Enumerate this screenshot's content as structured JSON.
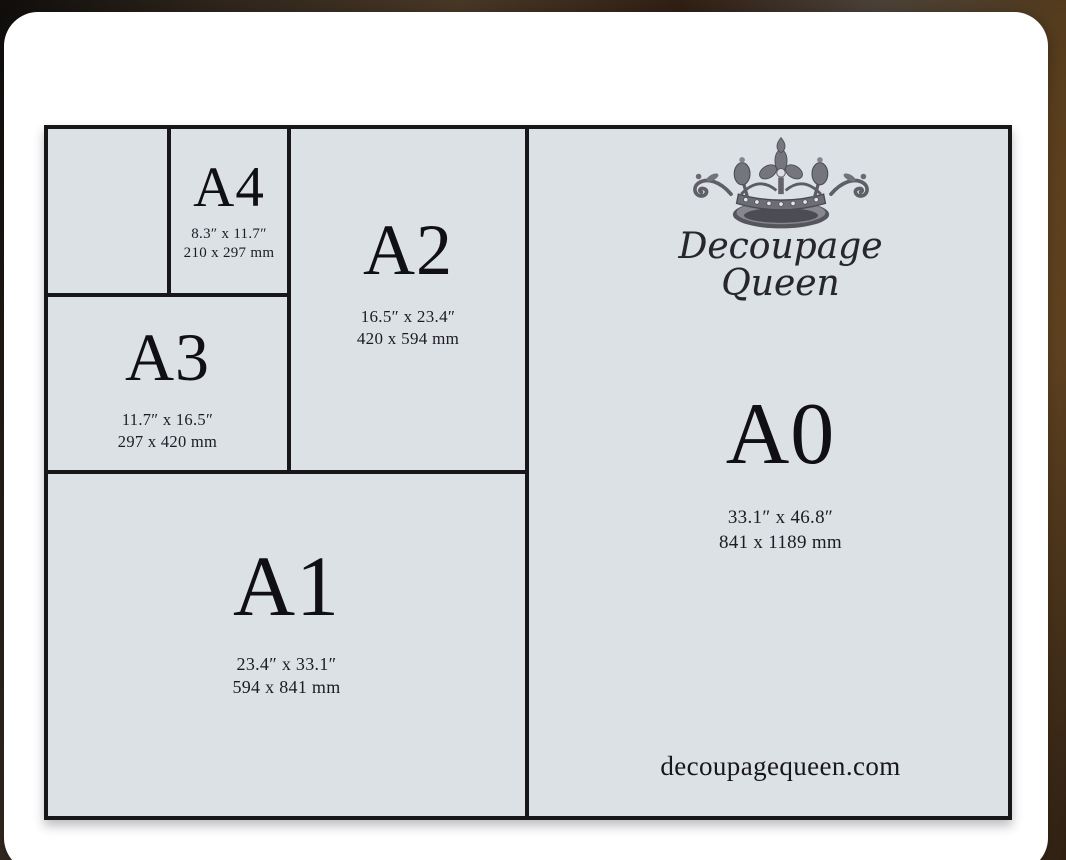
{
  "brand": {
    "line1": "Decoupage",
    "line2": "Queen",
    "website": "decoupagequeen.com"
  },
  "sizes": {
    "a4": {
      "label": "A4",
      "inches": "8.3″ x 11.7″",
      "mm": "210 x 297 mm"
    },
    "a3": {
      "label": "A3",
      "inches": "11.7″ x 16.5″",
      "mm": "297 x 420 mm"
    },
    "a2": {
      "label": "A2",
      "inches": "16.5″ x 23.4″",
      "mm": "420 x 594 mm"
    },
    "a1": {
      "label": "A1",
      "inches": "23.4″ x 33.1″",
      "mm": "594 x 841 mm"
    },
    "a0": {
      "label": "A0",
      "inches": "33.1″ x 46.8″",
      "mm": "841 x 1189 mm"
    }
  },
  "icons": {
    "crown": "crown-icon"
  },
  "colors": {
    "cell_bg": "#dce1e6",
    "line": "#17171a",
    "card": "#ffffff",
    "backdrop_brown": "#6b5238",
    "text": "#16161a"
  }
}
